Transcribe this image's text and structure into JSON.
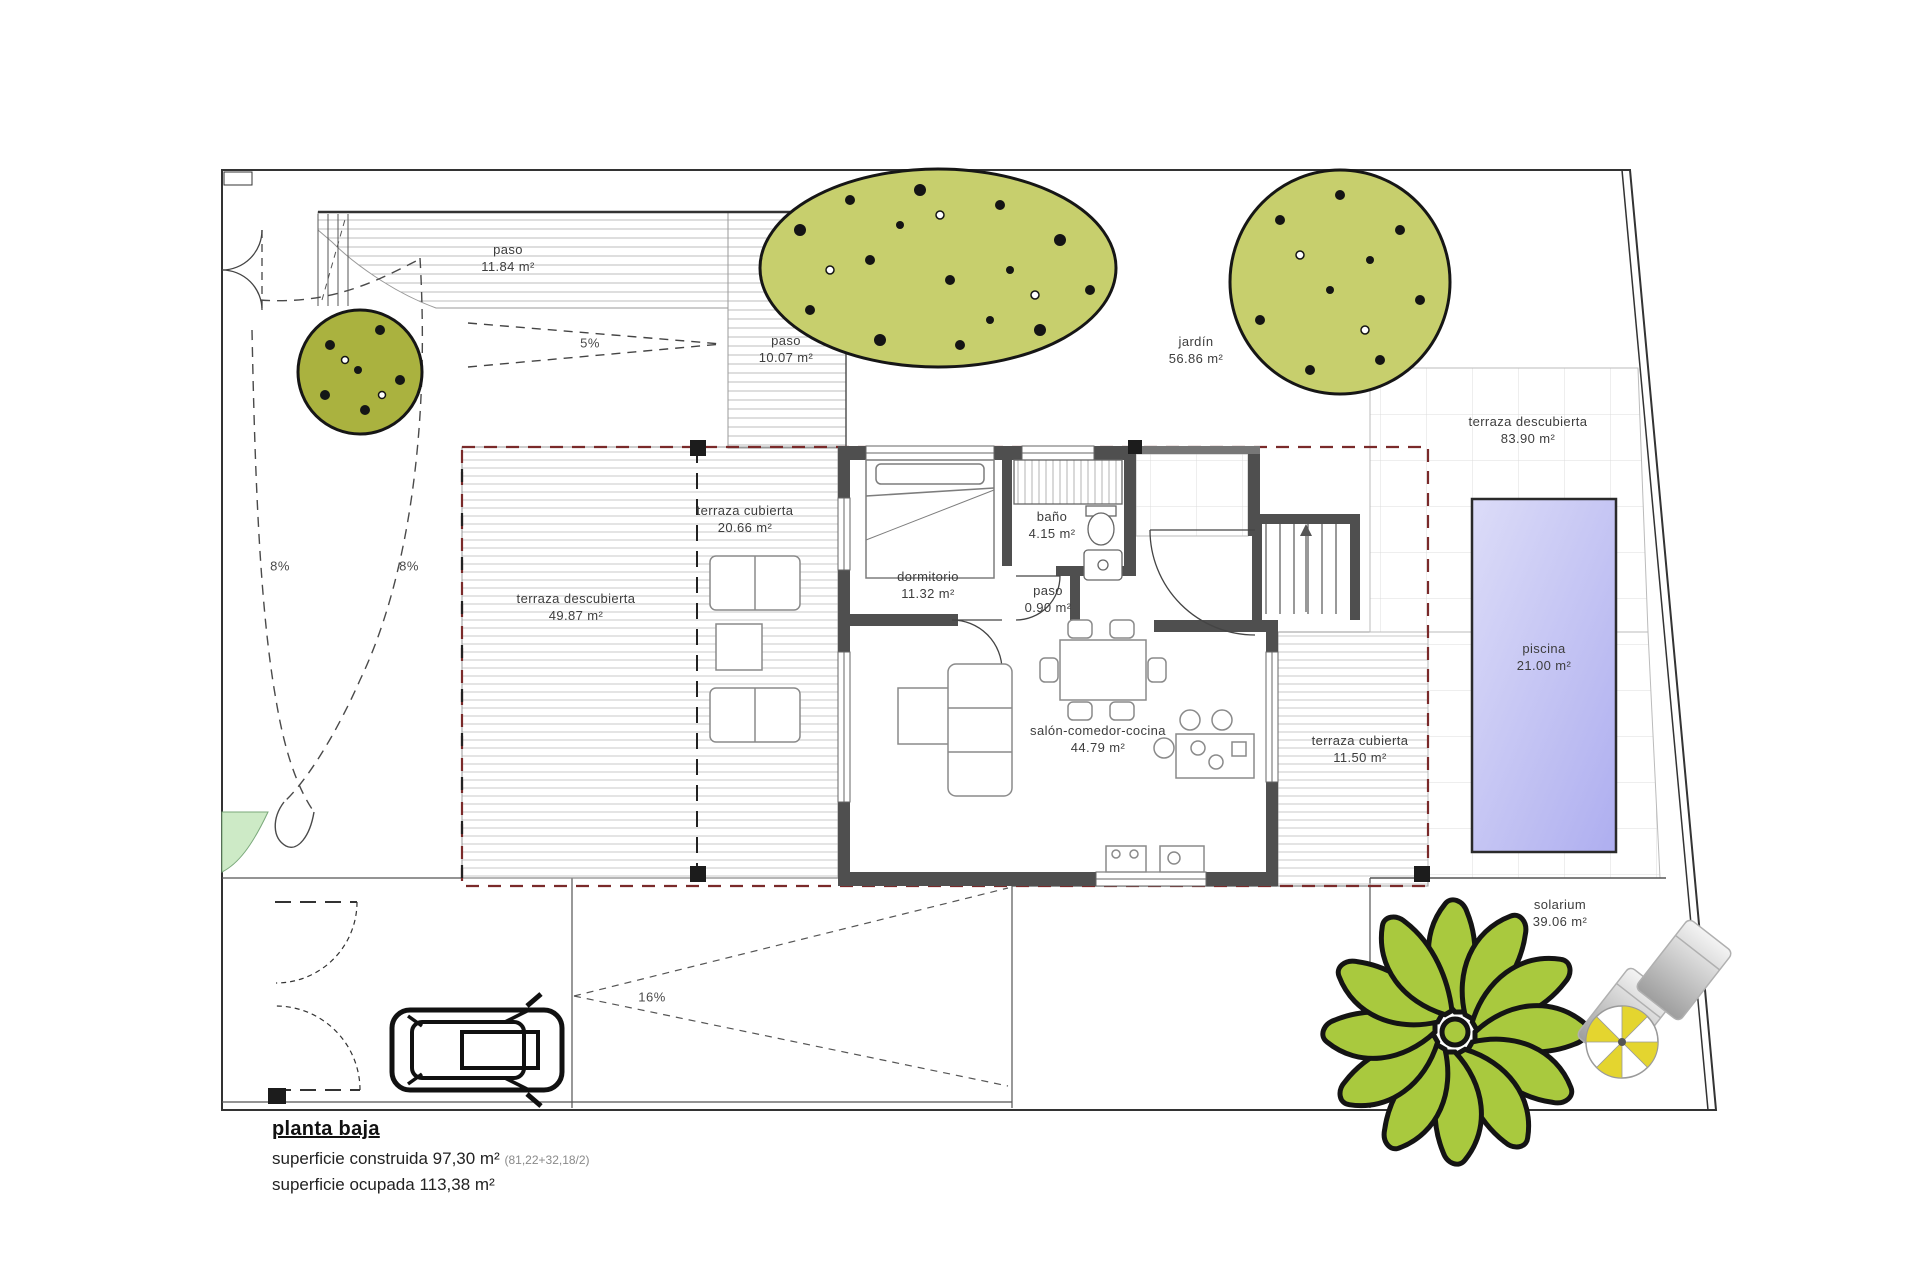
{
  "plan": {
    "footer": {
      "title": "planta baja",
      "construida_label": "superficie construida",
      "construida_value": "97,30 m²",
      "construida_detail": "(81,22+32,18/2)",
      "ocupada_label": "superficie ocupada",
      "ocupada_value": "113,38 m²"
    },
    "rooms": [
      {
        "name": "paso",
        "area": "11.84 m²"
      },
      {
        "name": "paso",
        "area": "10.07 m²"
      },
      {
        "name": "jardín",
        "area": "56.86 m²"
      },
      {
        "name": "terraza descubierta",
        "area": "83.90 m²"
      },
      {
        "name": "terraza cubierta",
        "area": "20.66 m²"
      },
      {
        "name": "dormitorio",
        "area": "11.32 m²"
      },
      {
        "name": "baño",
        "area": "4.15 m²"
      },
      {
        "name": "paso",
        "area": "0.90 m²"
      },
      {
        "name": "terraza descubierta",
        "area": "49.87 m²"
      },
      {
        "name": "salón-comedor-cocina",
        "area": "44.79 m²"
      },
      {
        "name": "terraza cubierta",
        "area": "11.50 m²"
      },
      {
        "name": "piscina",
        "area": "21.00 m²"
      },
      {
        "name": "solarium",
        "area": "39.06 m²"
      }
    ],
    "slopes": [
      {
        "label": "5%"
      },
      {
        "label": "8%"
      },
      {
        "label": "8%"
      },
      {
        "label": "16%"
      }
    ],
    "colors": {
      "wall": "#4f4f4f",
      "envelope_dash": "#7a2a2a",
      "pool_light": "#dcdcf8",
      "pool_dark": "#aeaef0",
      "tree": "#c7cf6d",
      "palm": "#a9c93e",
      "parasol": "#e4d52f",
      "grass_wedge": "#cdeac6"
    }
  }
}
